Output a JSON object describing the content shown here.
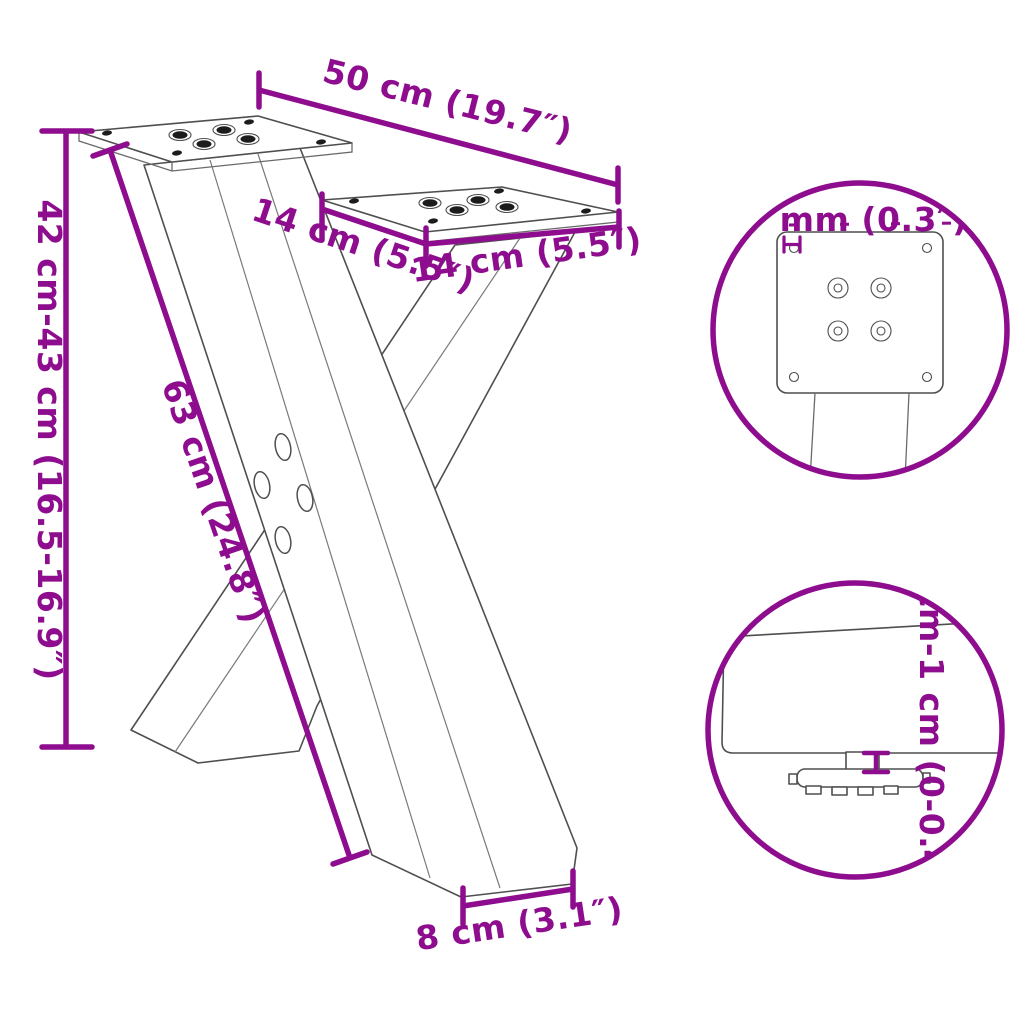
{
  "title": "X-shaped table leg dimension diagram",
  "accent_color": "#8E0D8E",
  "outline_color": "#4f4f4f",
  "background_color": "#ffffff",
  "labels": {
    "top_width": "50 cm (19.7″)",
    "plate_side_depth": "14 cm (5.5″)",
    "plate_front_width": "14 cm (5.5″)",
    "height_range": "42 cm-43 cm (16.5-16.9″)",
    "diagonal_length": "63 cm (24.8″)",
    "foot_width": "8 cm (3.1″)",
    "plate_thickness": "7 mm (0.3″)",
    "height_adjustment": "0 cm-1 cm (0-0.4″)"
  }
}
